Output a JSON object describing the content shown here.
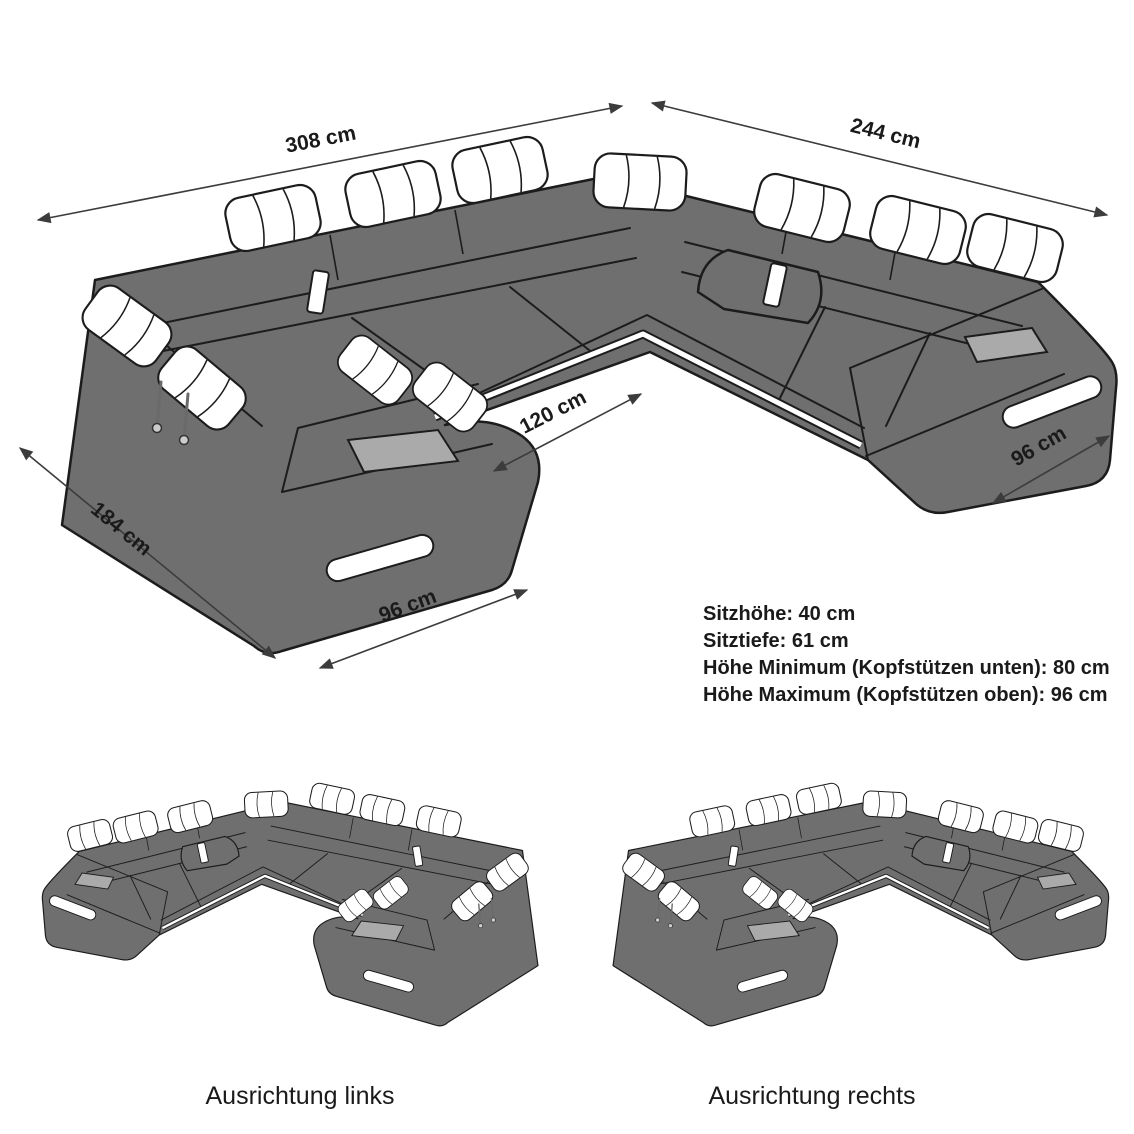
{
  "diagram": {
    "dimensions": {
      "back_width": "308 cm",
      "right_depth": "244 cm",
      "left_depth": "184 cm",
      "chaise_width": "96 cm",
      "inner_opening": "120 cm",
      "arm_width_right": "96 cm"
    },
    "specs": [
      "Sitzhöhe: 40 cm",
      "Sitztiefe: 61 cm",
      "Höhe Minimum (Kopfstützen unten): 80 cm",
      "Höhe Maximum (Kopfstützen oben): 96 cm"
    ],
    "variants": [
      {
        "label": "Ausrichtung links"
      },
      {
        "label": "Ausrichtung rechts"
      }
    ],
    "colors": {
      "body": "#6f6f6f",
      "outline": "#1c1c1c",
      "cushion": "#ffffff",
      "tray": "#aaaaaa",
      "dimension": "#3c3c3c",
      "text": "#1a1a1a",
      "background": "#ffffff"
    }
  }
}
